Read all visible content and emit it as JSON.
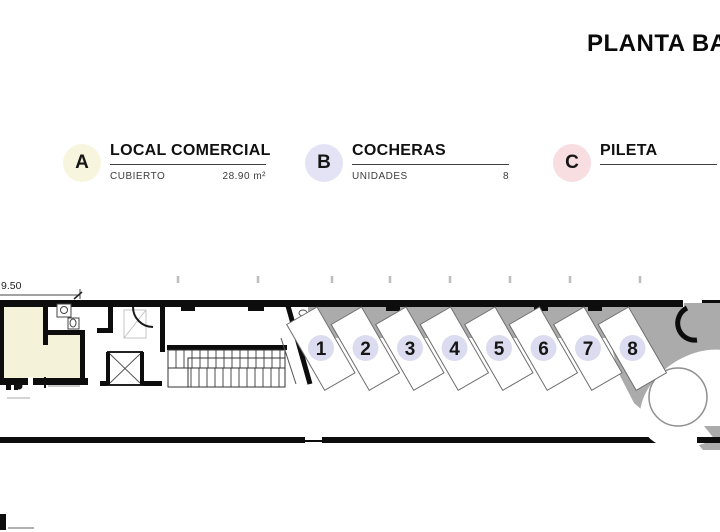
{
  "title": "PLANTA BAJA",
  "legend": {
    "items": [
      {
        "key": "A",
        "name": "LOCAL COMERCIAL",
        "detail_label": "CUBIERTO",
        "detail_value": "28.90 m²",
        "circle_color": "#f7f5de"
      },
      {
        "key": "B",
        "name": "COCHERAS",
        "detail_label": "UNIDADES",
        "detail_value": "8",
        "circle_color": "#e3e3f5"
      },
      {
        "key": "C",
        "name": "PILETA",
        "detail_label": "",
        "detail_value": "",
        "circle_color": "#f8dde1"
      }
    ]
  },
  "plan": {
    "dimension_label": "9.50",
    "spaces": [
      {
        "label": "1"
      },
      {
        "label": "2"
      },
      {
        "label": "3"
      },
      {
        "label": "4"
      },
      {
        "label": "5"
      },
      {
        "label": "6"
      },
      {
        "label": "7"
      },
      {
        "label": "8"
      }
    ],
    "colors": {
      "room_fill": "#f5f2da",
      "ground": "#ababab",
      "space_circle": "#dcdcf1",
      "wall": "#0d0d0d"
    }
  }
}
